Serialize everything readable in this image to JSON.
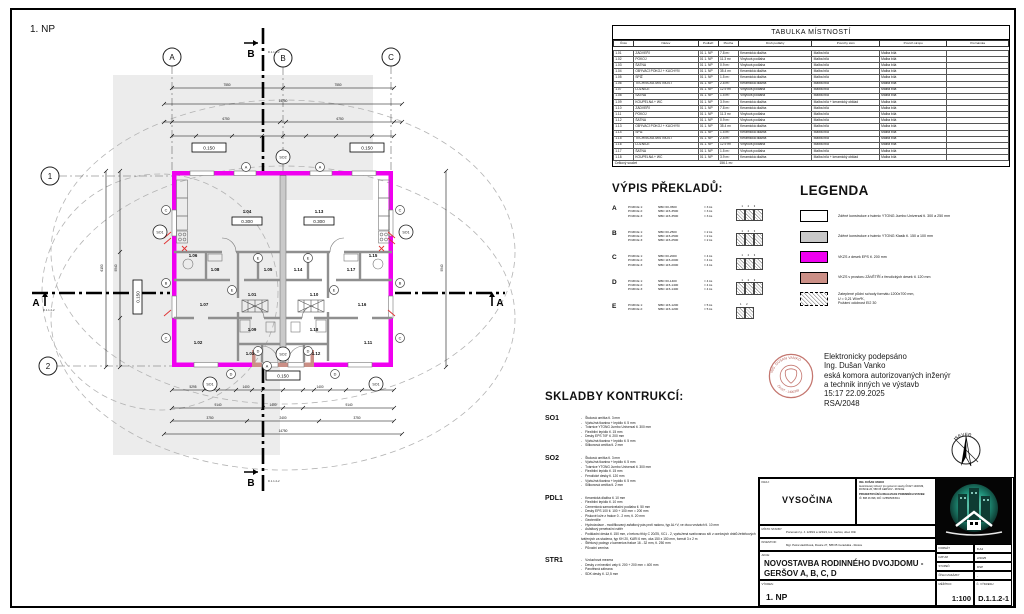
{
  "plan": {
    "sheet_title": "1. NP",
    "grid_cols": [
      "A",
      "B",
      "C"
    ],
    "grid_rows": [
      "1",
      "2"
    ],
    "section_a": "A",
    "section_b": "B",
    "section_ref": "D.1.1.2-2",
    "elev_top_left": "0.150",
    "elev_top_right": "0.150",
    "elev_left": "0.150",
    "elev_bottom": "0.150",
    "rooms": [
      {
        "id": "1.04",
        "elev": "0.300"
      },
      {
        "id": "1.13",
        "elev": "0.300"
      },
      {
        "id": "1.06"
      },
      {
        "id": "1.15"
      },
      {
        "id": "1.08"
      },
      {
        "id": "1.17"
      },
      {
        "id": "1.05"
      },
      {
        "id": "1.14"
      },
      {
        "id": "1.01"
      },
      {
        "id": "1.10"
      },
      {
        "id": "1.07"
      },
      {
        "id": "1.16"
      },
      {
        "id": "1.02"
      },
      {
        "id": "1.11"
      },
      {
        "id": "1.03"
      },
      {
        "id": "1.12"
      },
      {
        "id": "1.09"
      },
      {
        "id": "1.18"
      }
    ],
    "so_markers": [
      "SO1",
      "SO2"
    ],
    "lintel_markers": [
      "A",
      "B",
      "C",
      "D",
      "E"
    ],
    "dims": {
      "top": [
        "7550",
        "7550",
        "14750",
        "6750",
        "6750"
      ],
      "bottom": [
        "5295",
        "1400",
        "1400",
        "5295",
        "9140",
        "1400",
        "9140",
        "3750",
        "2400",
        "3750",
        "14750"
      ],
      "side": [
        "9540",
        "6150"
      ]
    }
  },
  "room_table": {
    "title": "TABULKA MÍSTNOSTÍ",
    "columns": [
      "Číslo",
      "Název",
      "Podlaží",
      "Plocha",
      "Druh podlahy",
      "Povrchy stěn",
      "Povrch stropu",
      "Poznámka"
    ],
    "rows": [
      [
        "1.01",
        "ZÁDVEŘÍ",
        "01 1. NP",
        "7.8 m²",
        "Keramická dlažba",
        "Malba bílá",
        "Malba bílá",
        ""
      ],
      [
        "1.02",
        "POKOJ",
        "01 1. NP",
        "11.3 m²",
        "Vinylová podlaha",
        "Malba bílá",
        "Malba bílá",
        ""
      ],
      [
        "1.03",
        "ŠATNA",
        "01 1. NP",
        "0.9 m²",
        "Vinylová podlaha",
        "Malba bílá",
        "Malba bílá",
        ""
      ],
      [
        "1.04",
        "OBÝVACÍ POKOJ + KUCHYŇ",
        "01 1. NP",
        "35.4 m²",
        "Keramická dlažba",
        "Malba bílá",
        "Malba bílá",
        ""
      ],
      [
        "1.05",
        "SPÍŽ",
        "01 1. NP",
        "1.5 m²",
        "Keramická dlažba",
        "Malba bílá",
        "Malba bílá",
        ""
      ],
      [
        "1.06",
        "TECHNICKÁ MÍSTNOST",
        "01 1. NP",
        "2.8 m²",
        "Keramická dlažba",
        "Malba bílá",
        "Malba bílá",
        ""
      ],
      [
        "1.07",
        "LOŽNICE",
        "01 1. NP",
        "12.9 m²",
        "Vinylová podlaha",
        "Malba bílá",
        "Malba bílá",
        ""
      ],
      [
        "1.08",
        "ŠATNA",
        "01 1. NP",
        "1.5 m²",
        "Vinylová podlaha",
        "Malba bílá",
        "Malba bílá",
        ""
      ],
      [
        "1.09",
        "KOUPELNA + WC",
        "01 1. NP",
        "3.9 m²",
        "Keramická dlažba",
        "Malba bílá + keramický obklad",
        "Malba bílá",
        ""
      ],
      [
        "1.10",
        "ZÁDVEŘÍ",
        "01 1. NP",
        "7.8 m²",
        "Keramická dlažba",
        "Malba bílá",
        "Malba bílá",
        ""
      ],
      [
        "1.11",
        "POKOJ",
        "01 1. NP",
        "11.3 m²",
        "Vinylová podlaha",
        "Malba bílá",
        "Malba bílá",
        ""
      ],
      [
        "1.12",
        "ŠATNA",
        "01 1. NP",
        "0.9 m²",
        "Vinylová podlaha",
        "Malba bílá",
        "Malba bílá",
        ""
      ],
      [
        "1.13",
        "OBÝVACÍ POKOJ + KUCHYŇ",
        "01 1. NP",
        "35.4 m²",
        "Keramická dlažba",
        "Malba bílá",
        "Malba bílá",
        ""
      ],
      [
        "1.14",
        "SPÍŽ",
        "01 1. NP",
        "1.5 m²",
        "Keramická dlažba",
        "Malba bílá",
        "Malba bílá",
        ""
      ],
      [
        "1.15",
        "TECHNICKÁ MÍSTNOST",
        "01 1. NP",
        "2.8 m²",
        "Keramická dlažba",
        "Malba bílá",
        "Malba bílá",
        ""
      ],
      [
        "1.16",
        "LOŽNICE",
        "01 1. NP",
        "12.9 m²",
        "Vinylová podlaha",
        "Malba bílá",
        "Malba bílá",
        ""
      ],
      [
        "1.17",
        "ŠATNA",
        "01 1. NP",
        "1.5 m²",
        "Vinylová podlaha",
        "Malba bílá",
        "Malba bílá",
        ""
      ],
      [
        "1.18",
        "KOUPELNA + WC",
        "01 1. NP",
        "3.9 m²",
        "Keramická dlažba",
        "Malba bílá + keramický obklad",
        "Malba bílá",
        ""
      ]
    ],
    "total_label": "Celkový součet",
    "total_value": "156.1 m²"
  },
  "vypis": {
    "title": "VÝPIS PŘEKLADŮ:",
    "items": [
      {
        "key": "A",
        "diag": "1 2 3",
        "rows": [
          [
            "POZICE 1:",
            "NBD 60-3500",
            "= 3 ks"
          ],
          [
            "POZICE 2:",
            "NBD 115-3500",
            "= 3 ks"
          ],
          [
            "POZICE 3:",
            "NBD 115-3500",
            "= 3 ks"
          ]
        ]
      },
      {
        "key": "B",
        "diag": "1 2 3",
        "rows": [
          [
            "POZICE 1:",
            "NBD 60-2500",
            "= 2 ks"
          ],
          [
            "POZICE 2:",
            "NBD 115-2500",
            "= 2 ks"
          ],
          [
            "POZICE 3:",
            "NBD 115-2500",
            "= 2 ks"
          ]
        ]
      },
      {
        "key": "C",
        "diag": "1 2 3",
        "rows": [
          [
            "POZICE 1:",
            "NBD 60-2000",
            "= 4 ks"
          ],
          [
            "POZICE 2:",
            "NBD 115-2000",
            "= 4 ks"
          ],
          [
            "POZICE 3:",
            "NBD 115-2000",
            "= 4 ks"
          ]
        ]
      },
      {
        "key": "D",
        "diag": "1 2 3",
        "rows": [
          [
            "POZICE 1:",
            "NBD 60-1400",
            "= 4 ks"
          ],
          [
            "POZICE 2:",
            "NBD 115-1400",
            "= 4 ks"
          ],
          [
            "POZICE 3:",
            "NBD 115-1400",
            "= 4 ks"
          ]
        ]
      },
      {
        "key": "E",
        "diag": "1 2",
        "rows": [
          [
            "POZICE 1:",
            "NBD 115-1200",
            "= 5 ks"
          ],
          [
            "POZICE 2:",
            "NBD 115-1200",
            "= 5 ks"
          ]
        ]
      }
    ]
  },
  "legenda": {
    "title": "LEGENDA",
    "items": [
      {
        "swatch": "white",
        "text": "Zděné konstrukce z tvárnic YTONG Jumbo Univerzal tl. 300 a 250 mm"
      },
      {
        "swatch": "gray",
        "text": "Zděné konstrukce z tvárnic YTONG Klasik tl. 150 a 100 mm"
      },
      {
        "swatch": "magenta",
        "text": "VKZS z desek EPS tl. 200 mm"
      },
      {
        "swatch": "rose",
        "text": "VKZS v prostoru ZÁVĚTŘÍ z fenolických desek tl. 120 mm"
      },
      {
        "swatch": "hatch",
        "text": "Zateplené půdní schody formátu 1200x700 mm,\nU = 0,21 W/m²K,\nPožární odolnost EI2 30"
      }
    ]
  },
  "skladby": {
    "title": "SKLADBY KONTRUKCÍ:",
    "sections": [
      {
        "code": "SO1",
        "layers": [
          "Štuková omítka tl. 3 mm",
          "Výztužná tkanina + lepidlo tl. 5 mm",
          "Tvárnice YTONG Jumbo Univerzal tl. 300 mm",
          "Flexibilní lepidlo tl. 15 mm",
          "Desky EPS 70F tl. 200 mm",
          "Výztužná tkanina + lepidlo tl. 5 mm",
          "Silikonová omítka tl. 2 mm"
        ]
      },
      {
        "code": "SO2",
        "layers": [
          "Štuková omítka tl. 3 mm",
          "Výztužná tkanina + lepidlo tl. 5 mm",
          "Tvárnice YTONG Jumbo Univerzal tl. 300 mm",
          "Flexibilní lepidlo tl. 15 mm",
          "Fenolické desky tl. 120 mm",
          "Výztužná tkanina + lepidlo tl. 5 mm",
          "Silikonová omítka tl. 2 mm"
        ]
      },
      {
        "code": "PDL1",
        "layers": [
          "Keramická dlažba tl. 10 mm",
          "Flexibilní lepidlo tl. 10 mm",
          "Cementová samonivelační podlaha tl. 50 mm",
          "Desky EPS 100 tl. 100 + 100 mm = 200 mm",
          "Pískové lože z frakce 0 - 2 mm, tl. 20 mm",
          "Geotextílie",
          "Hydroizolace - modifikovaný asfaltový pás proti radonu, typ AL+V, ve dvou vrstvách tl. 10 mm",
          "Asfaltový penetrační nátěr",
          "Podkladní deska tl. 150 mm, z betonu třídy C 20/25, XC1 - 2, vyztužená svařovanou sítí z ocelových drátů žebírkových tvářených za studena, typ KH 20, KARI 6 mm, oka 150 x 150 mm, formát 3 x 2 m",
          "Štěrkový podsyp z kameniva frakce 16 - 32 mm, tl. 250 mm",
          "Původní zemina"
        ]
      },
      {
        "code": "STR1",
        "layers": [
          "Vzduchová mezera",
          "Desky z minerální vaty tl. 200 + 200 mm = 400 mm",
          "Parotěsná zábrana",
          "SDK desky tl. 12,5 mm"
        ]
      }
    ]
  },
  "signature": {
    "lines": [
      "Elektronicky podepsáno",
      "Ing. Dušan Vanko",
      "eská komora autorizovaných inženýr",
      "a technik    inných ve výstavb",
      "15:17 22.09.2025",
      "RSA/2048"
    ],
    "seal_top": "ING. DUŠAN VANKO",
    "seal_bottom": "ČKAIT - 1400339"
  },
  "north_label": "SEVER",
  "titleblock": {
    "kraj_label": "KRAJ:",
    "kraj": "VYSOČINA",
    "designer_lines": "ING. DUŠAN VANKO",
    "designer_sub": "Autorizovaný inženýr pro pozemní stavby ČKAIT 1400339, ROSICE 26, 588 05 GERŠOV - ROSICE",
    "firm_lines": "PROJEKTOVÁNÍ A REALIZACE POZEMNÍCH STAVEB",
    "firm_sub": "IČ: 888 46 998, DIČ: CZ8505054541",
    "misto_label": "MÍSTO STAVBY:",
    "misto": "Pozemek č.p. č. 1239/1 a 1234/4, k.ú. Geršov, obec Olší",
    "investor_label": "INVESTOR:",
    "investor": "Mgr. Petra Havlíčková, Rosice 27, 588 05 Ceradutka - Rosice",
    "akce_label": "AKCE:",
    "akce": "NOVOSTAVBA RODINNÉHO DVOJDOMU - GERŠOV A, B, C, D",
    "vykres_label": "VÝKRES:",
    "vykres": "1. NP",
    "meta": [
      {
        "label": "FORMÁT",
        "value": "8 A4"
      },
      {
        "label": "DATUM",
        "value": "2/2025"
      },
      {
        "label": "STUPEŇ",
        "value": "DSP"
      },
      {
        "label": "ČÍSLO ZAKÁZKY",
        "value": "-"
      }
    ],
    "meritko_label": "MĚŘÍTKO:",
    "meritko": "1:100",
    "cislo_label": "Č. VÝKRESU:",
    "cislo": "D.1.1.2-1"
  }
}
